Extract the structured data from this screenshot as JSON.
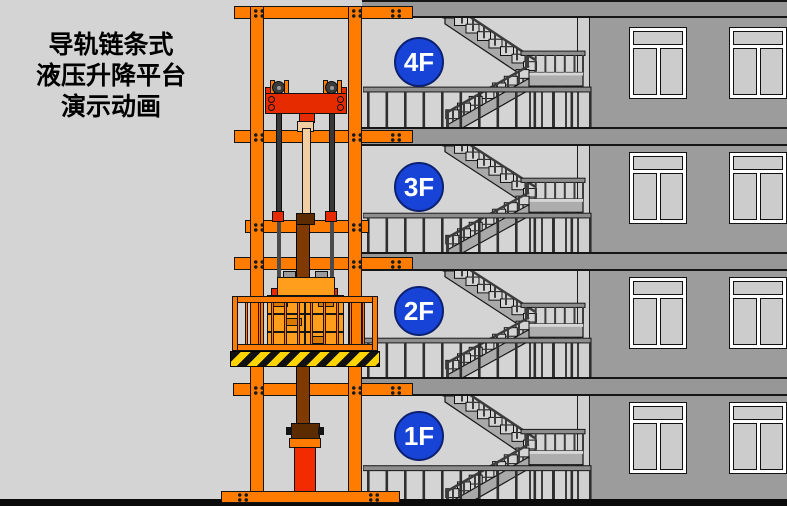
{
  "title": {
    "lines": [
      "导轨链条式",
      "液压升降平台",
      "演示动画"
    ]
  },
  "floors": [
    {
      "label": "4F"
    },
    {
      "label": "3F"
    },
    {
      "label": "2F"
    },
    {
      "label": "1F"
    }
  ],
  "colors": {
    "background": "#d4d4d4",
    "frame_orange": "#ff7c00",
    "machine_red": "#e62b00",
    "cylinder_red": "#f32b00",
    "piston_brown": "#7e3a00",
    "piston_rod_tan": "#f2cfa2",
    "cargo_orange": "#ff9d1c",
    "floor_badge_blue": "#1743d6",
    "hazard_yellow": "#ffd400",
    "wall_gray": "#9c9c9c",
    "slab_gray": "#979797",
    "stair_gray": "#a9a9a9",
    "railing_gray": "#3d3d3d",
    "ground_black": "#0b0b0b"
  }
}
